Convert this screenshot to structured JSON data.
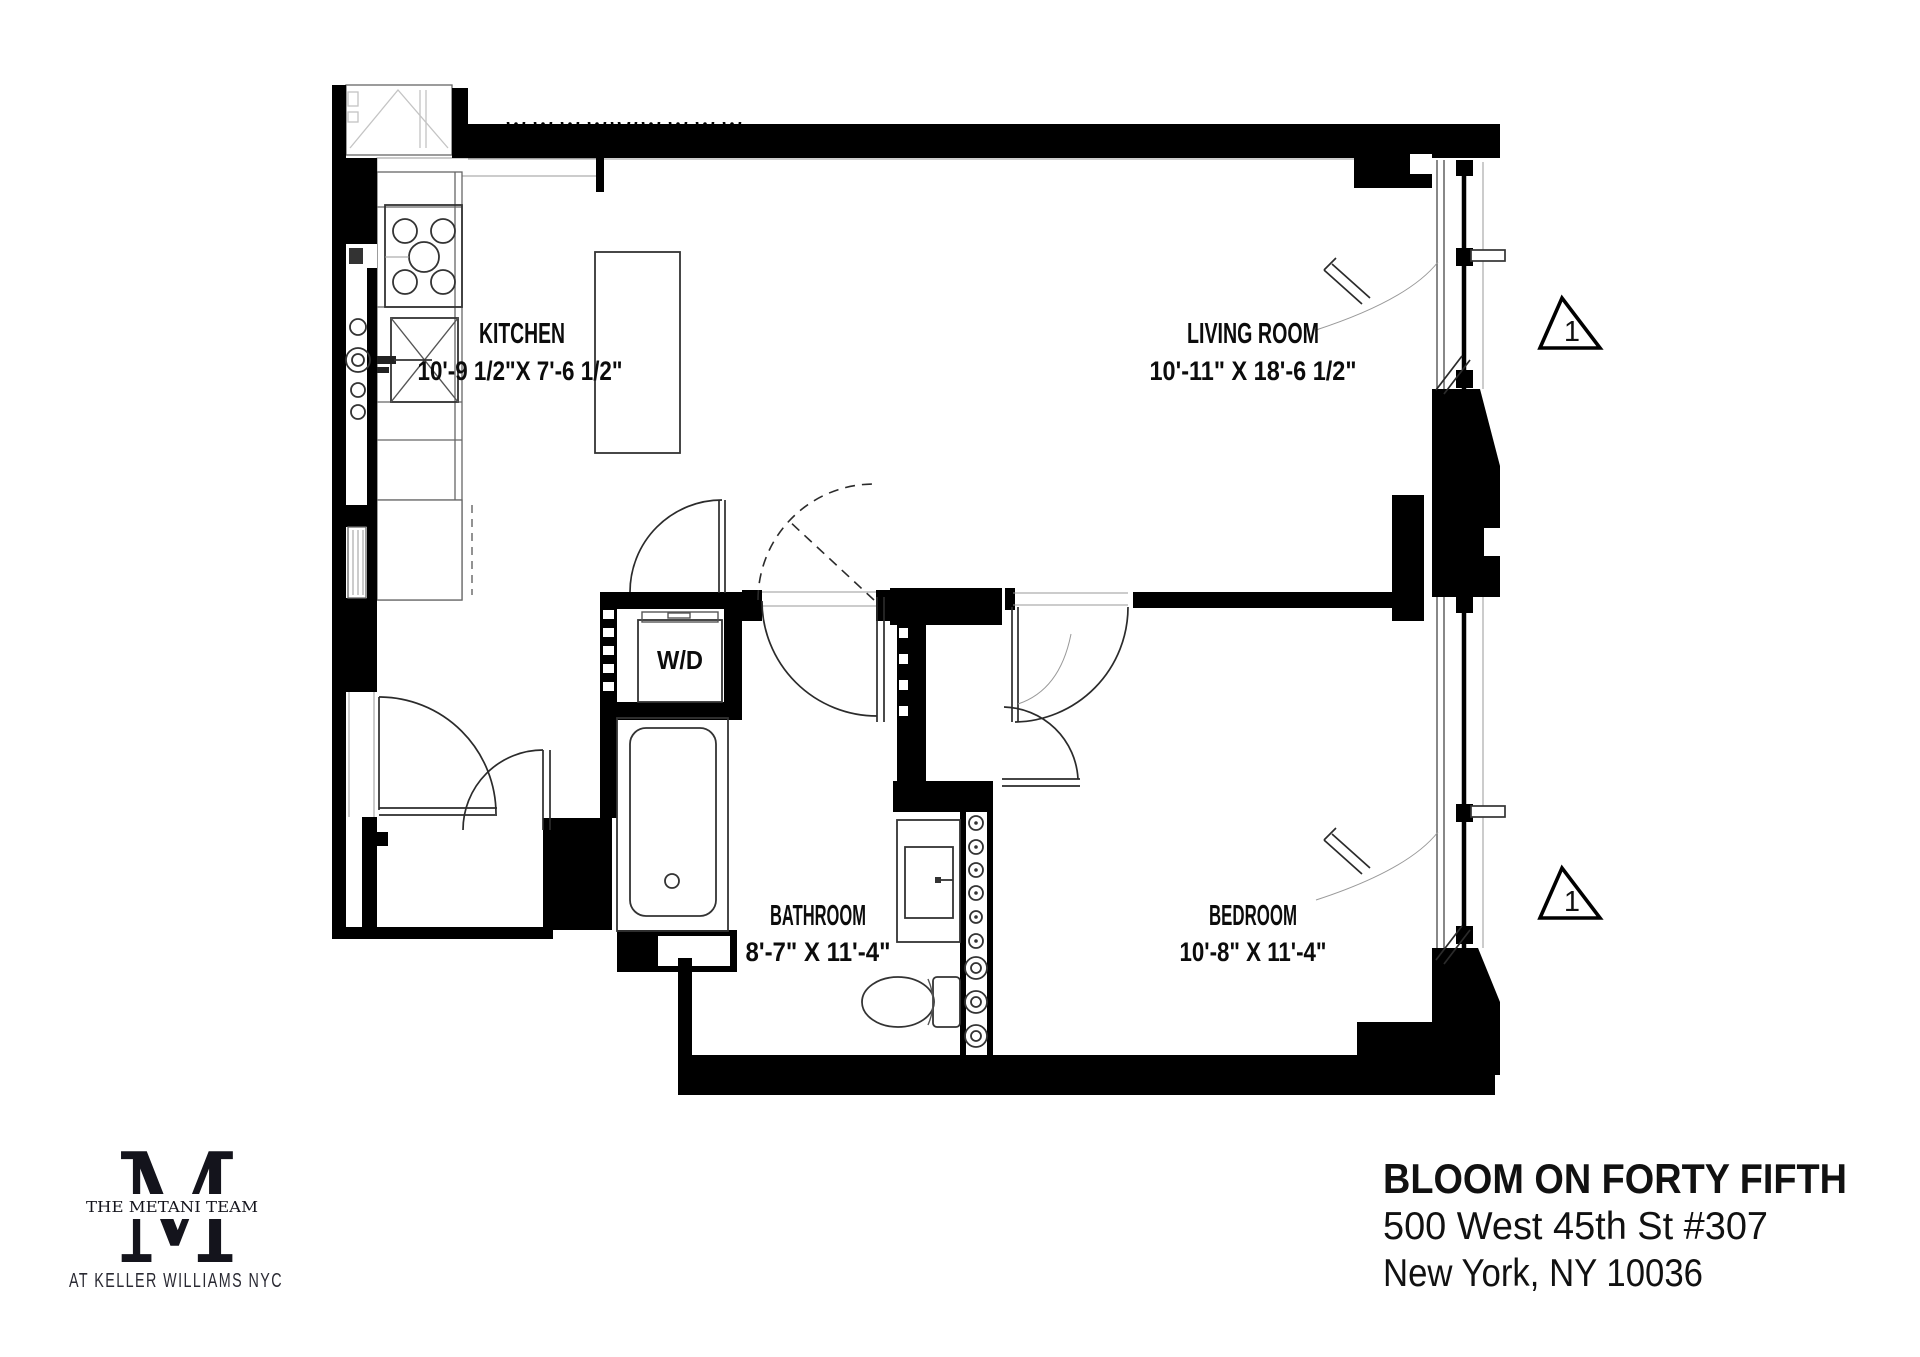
{
  "colors": {
    "background": "#ffffff",
    "wall": "#000000",
    "line": "#333333",
    "text": "#111111"
  },
  "floor_plan": {
    "rooms": [
      {
        "name": "KITCHEN",
        "dimensions": "10'-9 1/2\"X 7'-6 1/2\""
      },
      {
        "name": "LIVING ROOM",
        "dimensions": "10'-11\" X 18'-6 1/2\""
      },
      {
        "name": "BATHROOM",
        "dimensions": "8'-7\" X 11'-4\""
      },
      {
        "name": "BEDROOM",
        "dimensions": "10'-8\" X 11'-4\""
      }
    ],
    "appliance_label": "W/D",
    "window_markers": [
      {
        "label": "1"
      },
      {
        "label": "1"
      }
    ]
  },
  "branding": {
    "monogram": "M",
    "team_name": "THE METANI TEAM",
    "subtitle": "AT KELLER WILLIAMS NYC"
  },
  "listing": {
    "building_name": "BLOOM ON FORTY FIFTH",
    "address_line1": "500 West 45th St #307",
    "address_line2": "New York, NY 10036"
  }
}
